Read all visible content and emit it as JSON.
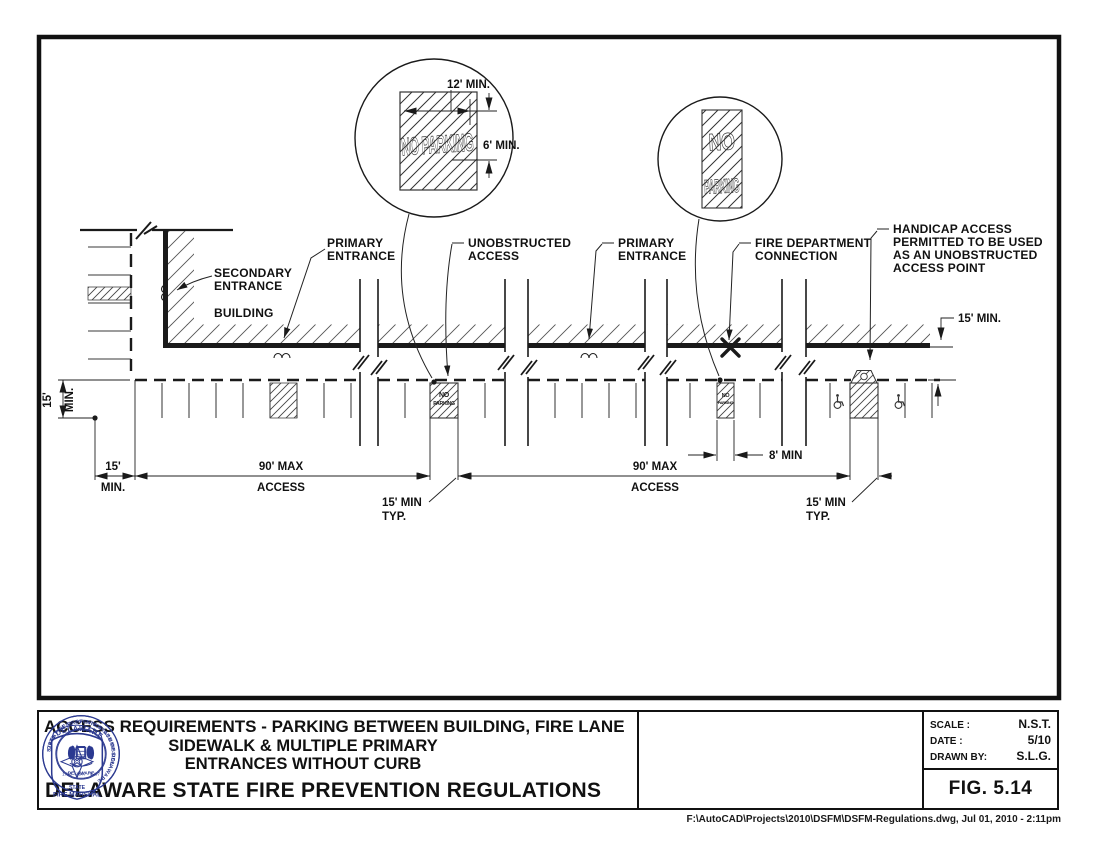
{
  "page": {
    "footer": "F:\\AutoCAD\\Projects\\2010\\DSFM\\DSFM-Regulations.dwg, Jul 01, 2010 - 2:11pm"
  },
  "colors": {
    "ink": "#1a1a1a",
    "seal_blue": "#2b3990"
  },
  "diagram": {
    "labels": {
      "secondary_entrance": [
        "SECONDARY",
        "ENTRANCE"
      ],
      "building": "BUILDING",
      "primary_entrance": [
        "PRIMARY",
        "ENTRANCE"
      ],
      "unobstructed_access": [
        "UNOBSTRUCTED",
        "ACCESS"
      ],
      "fire_department_connection": [
        "FIRE DEPARTMENT",
        "CONNECTION"
      ],
      "handicap_access": [
        "HANDICAP ACCESS",
        "PERMITTED TO BE USED",
        "AS AN UNOBSTRUCTED",
        "ACCESS POINT"
      ]
    },
    "dimensions": {
      "fire_lane_width": "15' MIN.",
      "left_width": [
        "15'",
        "MIN."
      ],
      "access_max": [
        "90' MAX",
        "ACCESS"
      ],
      "typical": [
        "15' MIN",
        "TYP."
      ],
      "fdc_clear": "8' MIN",
      "detail_width": "12' MIN.",
      "detail_height": "6' MIN."
    },
    "markings": {
      "no_parking": "NO PARKING",
      "no": "NO",
      "parking": "PARKING"
    }
  },
  "title_block": {
    "title": [
      "ACCESS REQUIREMENTS - PARKING BETWEEN BUILDING, FIRE LANE",
      "SIDEWALK & MULTIPLE PRIMARY",
      "ENTRANCES WITHOUT CURB"
    ],
    "organization": "DELAWARE STATE FIRE PREVENTION REGULATIONS",
    "scale_label": "SCALE :",
    "scale": "N.S.T.",
    "date_label": "DATE :",
    "date": "5/10",
    "drawn_by_label": "DRAWN BY:",
    "drawn_by": "S.L.G.",
    "figure": "FIG. 5.14",
    "seals": {
      "great_seal": "GREAT SEAL OF THE STATE OF DELAWARE",
      "great_seal_years": "1793 · 1847 · 1907",
      "marshal_banner": "DELAWARE",
      "marshal_line1": "STATE",
      "marshal_line2": "FIRE MARSHAL",
      "commission": "STATE FIRE PREVENTION COMMISSION",
      "commission_bottom": "· DELAWARE ·"
    }
  }
}
